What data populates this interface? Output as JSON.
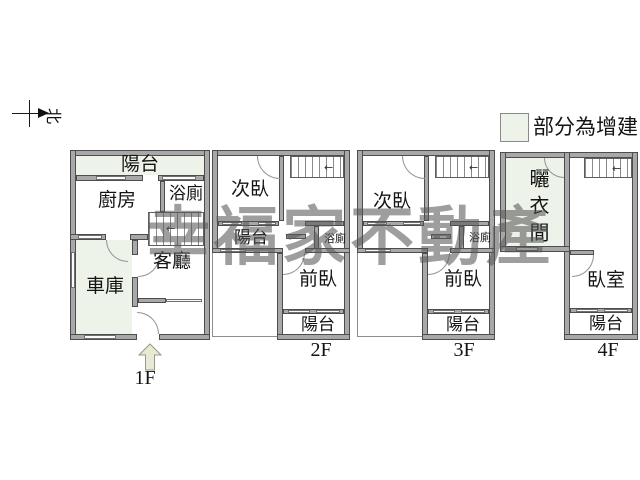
{
  "compass": {
    "north_label": "北"
  },
  "legend": {
    "label": "部分為增建",
    "swatch_color": "#edf3e8"
  },
  "watermark": {
    "text": "幸福家不動產"
  },
  "colors": {
    "wall_fill": "#a8a8a8",
    "wall_edge": "#4d4d4d",
    "addition_fill": "#edf3e8",
    "background": "#ffffff",
    "watermark_gray": "#585858",
    "entry_arrow_fill": "#e9e9d4"
  },
  "floors": {
    "f1": {
      "label": "1F",
      "balcony": "陽台",
      "kitchen": "廚房",
      "bath": "浴廁",
      "living_room": "客廳",
      "garage": "車庫"
    },
    "f2": {
      "label": "2F",
      "bedroom2": "次臥",
      "mid_balcony": "陽台",
      "bath": "浴廁",
      "front_bedroom": "前臥",
      "balcony": "陽台"
    },
    "f3": {
      "label": "3F",
      "bedroom2": "次臥",
      "bath": "浴廁",
      "front_bedroom": "前臥",
      "balcony": "陽台"
    },
    "f4": {
      "label": "4F",
      "drying_room": "曬衣間",
      "bedroom": "臥室",
      "balcony": "陽台"
    }
  }
}
